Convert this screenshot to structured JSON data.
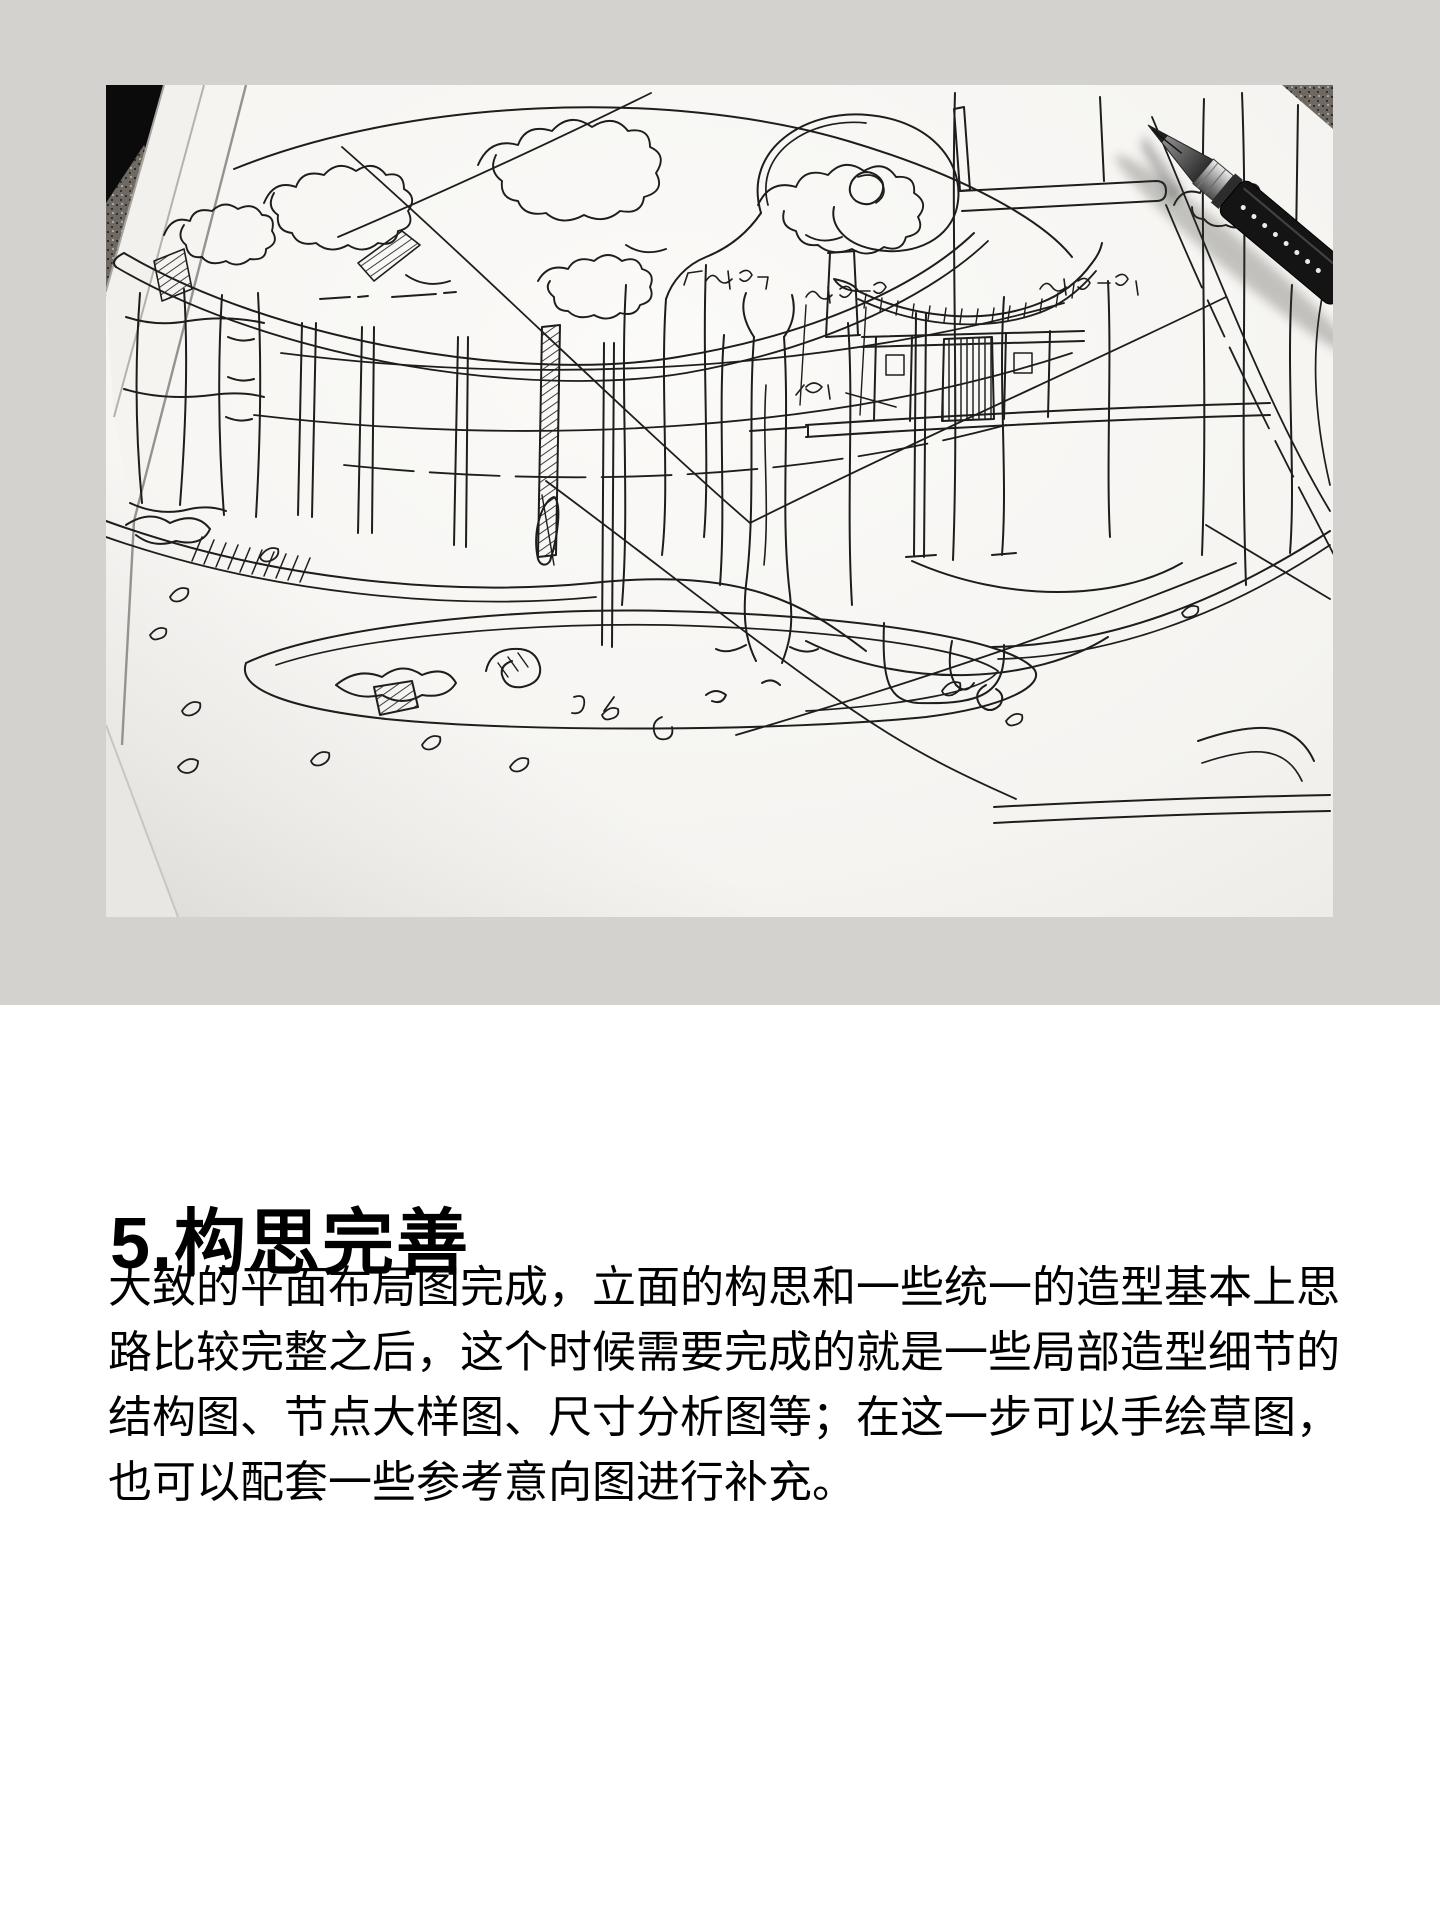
{
  "hero": {
    "background_color": "#d4d2ce",
    "photo": {
      "name": "hand-drawn-architecture-concept-sketch-with-pen",
      "paper_color": "#f7f6f3",
      "ink_color": "#1d1d1d",
      "pen_icon": "black-gel-pen"
    }
  },
  "article": {
    "heading": "5.构思完善",
    "paragraph_lines": [
      "大致的平面布局图完成，立面的构思和一些统一的造型基本上思",
      "路比较完整之后，这个时候需要完成的就是一些局部造型细节的",
      "结构图、节点大样图、尺寸分析图等；在这一步可以手绘草图，",
      "也可以配套一些参考意向图进行补充。"
    ],
    "text_color": "#000000"
  }
}
